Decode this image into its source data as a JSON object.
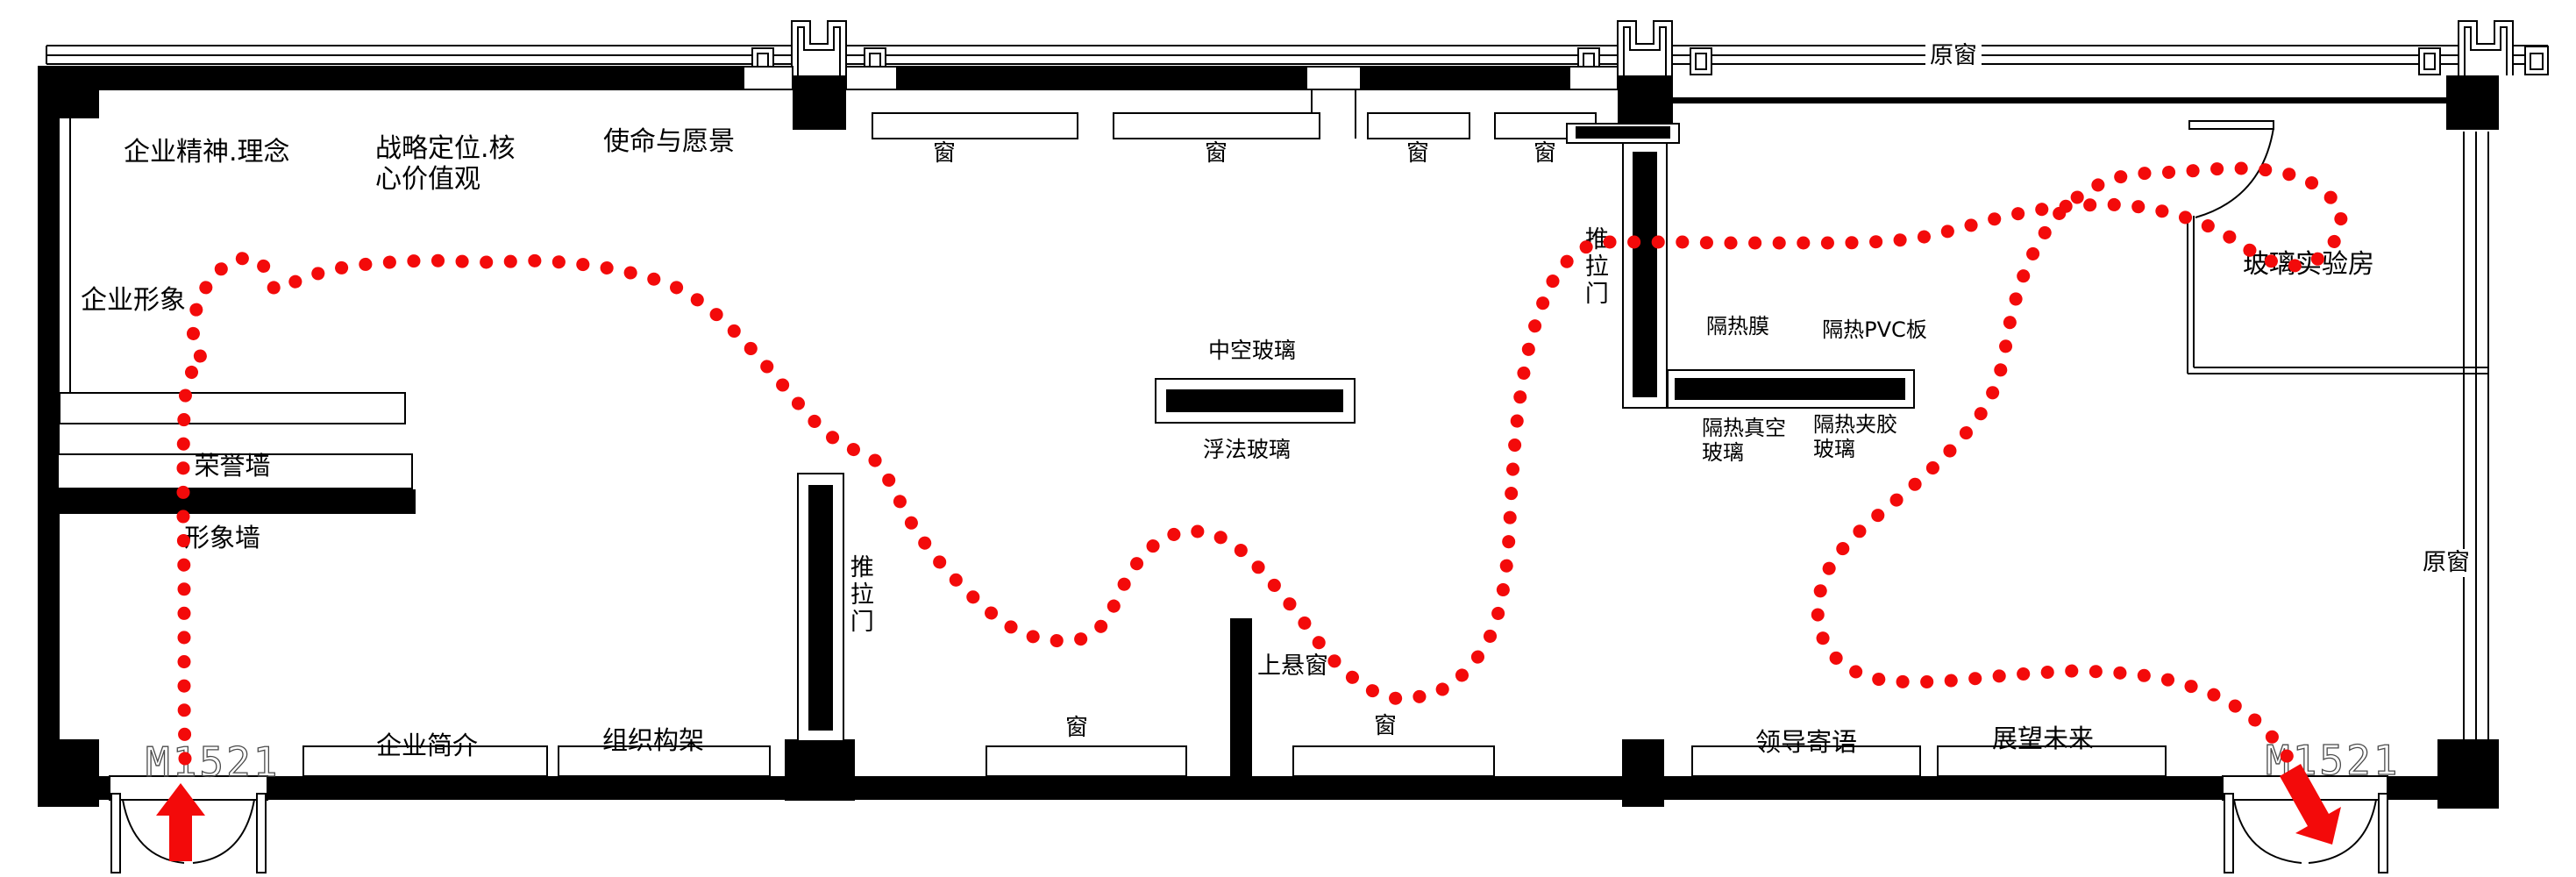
{
  "colors": {
    "route": "#f30a0a",
    "wall": "#000000"
  },
  "top_zone": {
    "spirit": "企业精神.理念",
    "strategy": "战略定位.核心价值观",
    "mission": "使命与愿景",
    "windows": {
      "w1": "窗",
      "w2": "窗",
      "w3": "窗",
      "w4": "窗"
    },
    "original_window": "原窗"
  },
  "left_zone": {
    "corporate_image": "企业形象",
    "honor_wall": "荣誉墙",
    "image_wall": "形象墙"
  },
  "bottom_zone": {
    "entry_code": "M1521",
    "company_intro": "企业简介",
    "org_structure": "组织构架",
    "window_left": "窗",
    "top_hung_window": "上悬窗",
    "window_right": "窗",
    "leader_message": "领导寄语",
    "future_outlook": "展望未来",
    "exit_code": "M1521"
  },
  "middle_zone": {
    "sliding_door": "推拉门",
    "insulated_glass": "中空玻璃",
    "float_glass": "浮法玻璃"
  },
  "right_zone": {
    "sliding_door": "推拉门",
    "heat_film": "隔热膜",
    "heat_pvc_board": "隔热PVC板",
    "heat_vacuum_glass": "隔热真空玻璃",
    "heat_laminated_glass": "隔热夹胶玻璃",
    "glass_lab": "玻璃实验房",
    "original_window": "原窗"
  }
}
